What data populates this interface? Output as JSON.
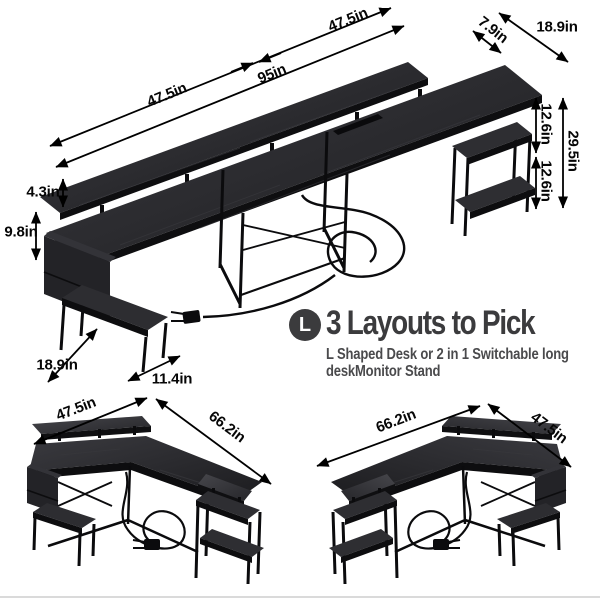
{
  "colors": {
    "background": "#ffffff",
    "desk_top": "#2a2a2e",
    "desk_edge": "#0e0e10",
    "accent_text": "#3b3b3d",
    "arrow": "#000000"
  },
  "heading": {
    "icon": "l-shaped-desk-badge-icon",
    "icon_letter": "L",
    "title": "3 Layouts to Pick",
    "subtitle_line1": "L Shaped Desk or 2 in 1 Switchable long",
    "subtitle_line2": "deskMonitor Stand"
  },
  "dims": {
    "main": [
      {
        "id": "left-half-length",
        "text": "47.5in"
      },
      {
        "id": "right-half-length",
        "text": "47.5in"
      },
      {
        "id": "total-length",
        "text": "95in"
      },
      {
        "id": "monitor-shelf-depth",
        "text": "7.9in"
      },
      {
        "id": "desk-depth",
        "text": "18.9in"
      },
      {
        "id": "monitor-riser-height",
        "text": "4.3in"
      },
      {
        "id": "storage-bag-height",
        "text": "9.8in"
      },
      {
        "id": "left-end-depth",
        "text": "18.9in"
      },
      {
        "id": "shelf-width",
        "text": "11.4in"
      },
      {
        "id": "upper-shelf-spacing",
        "text": "12.6in"
      },
      {
        "id": "lower-shelf-spacing",
        "text": "12.6in"
      },
      {
        "id": "overall-height",
        "text": "29.5in"
      }
    ],
    "l_desk_left": [
      {
        "id": "short-arm-length",
        "text": "47.5in"
      },
      {
        "id": "long-arm-length",
        "text": "66.2in"
      }
    ],
    "l_desk_right": [
      {
        "id": "long-arm-length",
        "text": "66.2in"
      },
      {
        "id": "short-arm-length",
        "text": "47.5in"
      }
    ]
  }
}
